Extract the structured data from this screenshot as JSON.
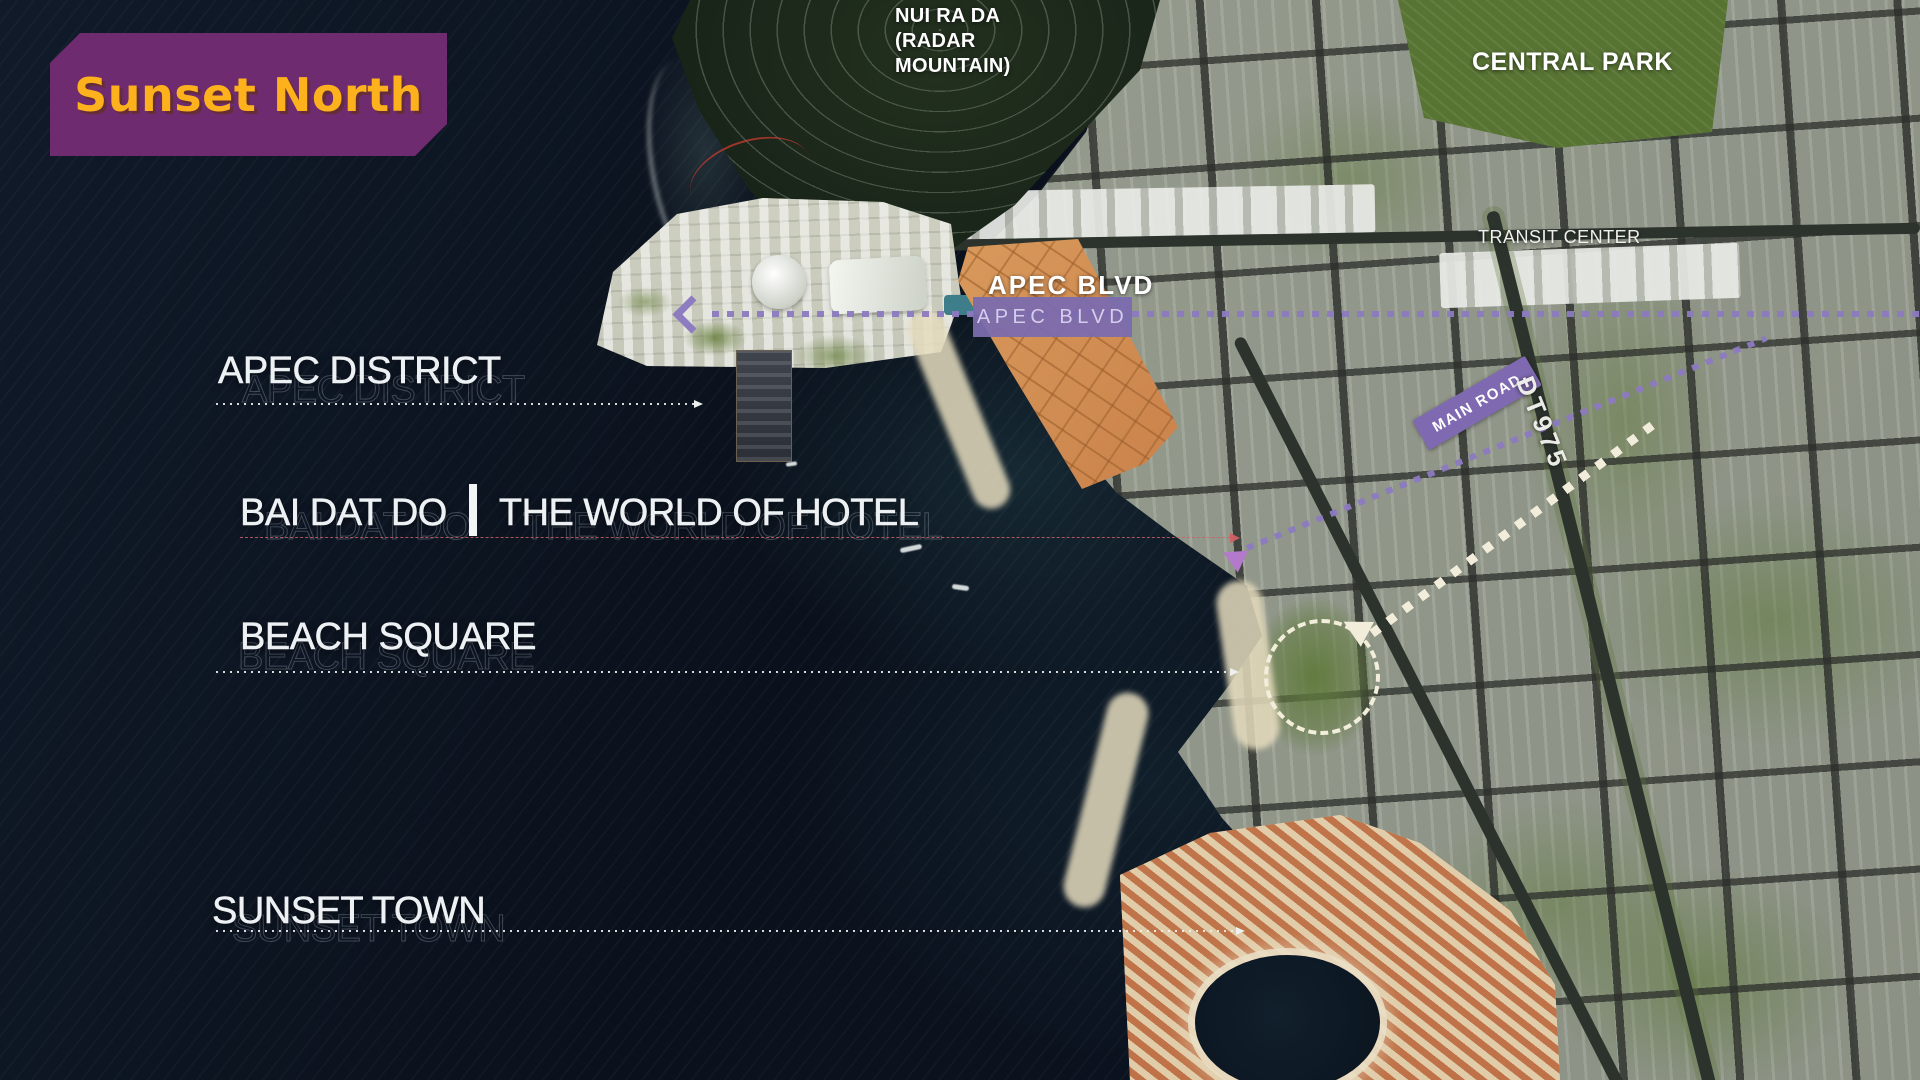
{
  "title_badge": {
    "label": "Sunset North"
  },
  "map_labels": {
    "mountain": "NUI RA DA\n(RADAR\nMOUNTAIN)",
    "central_park": "CENTRAL PARK",
    "transit_center": "TRANSIT CENTER",
    "apec_blvd": "APEC BLVD",
    "apec_blvd_bg": "APEC BLVD",
    "main_road": "MAIN ROAD",
    "route": "ĐT975"
  },
  "callouts": {
    "apec_district": "APEC DISTRICT",
    "bai_dat_do": "BAI DAT DO",
    "bai_dat_do_sub": "THE WORLD OF HOTEL",
    "beach_square": "BEACH SQUARE",
    "sunset_town": "SUNSET TOWN"
  },
  "colors": {
    "title_badge_bg": "#6f2b6f",
    "title_text": "#fcb11d",
    "route_badge_purple": "#7f6ab2",
    "dotted_line_purple": "#8d7cc0",
    "leader_line_white": "#f0f2f0",
    "leader_line_red": "#c65f62",
    "district_orange": "#d18c4f"
  }
}
